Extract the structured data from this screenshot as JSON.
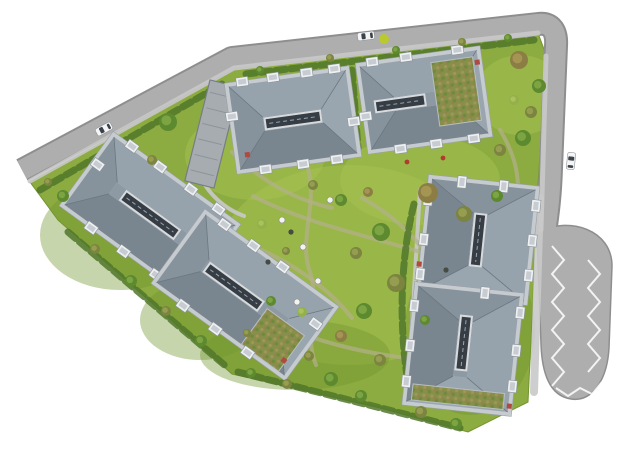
{
  "meta": {
    "type": "architectural-site-plan-rendering",
    "description": "Top-down aerial rendering of a residential masterplan: six apartment buildings with grey hip roofs, central skylight strips, white rooftop boxes and green-roof patches, set in a yellow-green landscaped garden with winding paths and trees, bounded by grey roads with three white cars and a parking loop with zigzag markings.",
    "canvas": {
      "width": 620,
      "height": 465
    }
  },
  "palette": {
    "grass": "#8cab40",
    "grass_light": "#a6c152",
    "grass_dark": "#71952f",
    "road": "#aeaeae",
    "road_edge": "#8e8e8e",
    "walk": "#c9c9c9",
    "marking": "#ffffff",
    "path_tan": "#b4b18c",
    "hedge": "#50772a",
    "slab": "#c6cbd0",
    "face_n": "#97a3ac",
    "face_s": "#79858f",
    "face_w": "#87939c",
    "face_e": "#9aa6af",
    "ridge": "#8e9aa3",
    "hipline": "#6b7680",
    "sky": "#363d44",
    "sky_frame": "#d7dbde",
    "roofbox": "#eef0f1",
    "box_edge": "#8a939b",
    "box_inner": "#c6ccd1",
    "vent": "#b0493f",
    "flower": "#b23b30",
    "car_body": "#f5f5f5",
    "car_glass": "#3a424c",
    "lime": "#b9c92e",
    "greenroof_base": "#878f4a",
    "greenroof_dot1": "#a09659",
    "greenroof_dot2": "#6f8a3e",
    "greenroof_dot3": "#96804c",
    "tree_green": "#5d892f",
    "tree_green_hi": "#81a945",
    "tree_olive": "#7c8440",
    "tree_olive_hi": "#9aa254",
    "tree_brown": "#8c7d45",
    "tree_brown_hi": "#a89a55",
    "tree_light": "#93b04b",
    "tree_light_hi": "#aec45f"
  },
  "scene": {
    "site_outline": "30,182 237,68 538,33 545,52 541,140 536,215 533,300 528,402 468,432 380,408 232,374 58,220",
    "lawn_patches": [
      [
        350,
        265,
        135,
        100,
        "light"
      ],
      [
        255,
        155,
        70,
        45,
        "light"
      ],
      [
        520,
        95,
        45,
        40,
        "light"
      ],
      [
        420,
        180,
        80,
        45,
        "light"
      ],
      [
        120,
        235,
        80,
        55,
        "dark"
      ],
      [
        470,
        330,
        65,
        85,
        "dark"
      ],
      [
        295,
        355,
        95,
        35,
        "dark"
      ],
      [
        200,
        320,
        60,
        40,
        "dark"
      ]
    ],
    "road_centerline": "M 22 170 L 232 58 L 538 24 C 552 22 557 32 556 46 L 551 168 C 550 200 547 218 544 240",
    "bulb_path": "M 537 232 C 570 216 612 230 612 266 L 609 348 C 607 382 591 402 571 399 C 550 396 542 374 541 344 L 538 262 Z",
    "walkways": [
      {
        "d": "M 30 181 L 234 68 L 538 33",
        "w": 5
      },
      {
        "d": "M 546 56 L 541 230",
        "w": 5
      },
      {
        "d": "M 540 198 L 534 392",
        "w": 8
      },
      {
        "d": "M 420 190 L 408 390",
        "w": 4
      },
      {
        "d": "M 205 185 C 215 200 228 210 244 216",
        "w": 4
      }
    ],
    "zigzag_markings": [
      "552,246 564,260 552,274 564,288 552,302 564,316 552,330 564,344 552,358 564,372 552,386",
      "588,260 600,274 588,288 600,302 588,316 600,330 588,344 600,358 588,372",
      "556,388 568,396 580,388 592,394 602,382"
    ],
    "garden_paths": [
      "M 308 168 C 318 205 298 240 310 272 C 320 300 303 335 316 365",
      "M 253 196 C 310 226 380 238 446 260",
      "M 232 152 C 262 182 296 200 332 208",
      "M 362 198 C 402 220 432 252 446 292 C 456 322 442 352 424 382",
      "M 292 330 C 332 346 372 354 420 360",
      "M 500 130 C 512 150 518 168 518 188",
      "M 262 250 C 300 268 330 290 352 318"
    ],
    "hedges": [
      "M 246 74 L 534 40",
      "M 40 190 L 222 84",
      "M 68 232 L 228 368",
      "M 238 372 L 460 428",
      "M 414 204 C 400 260 398 330 410 394",
      "M 352 70 L 358 148"
    ],
    "ramp": {
      "x": 212,
      "y": 134,
      "rot": 14,
      "w": 30,
      "len": 104,
      "ticks": 6
    },
    "buildings": [
      {
        "cx": 293,
        "cy": 120,
        "long": 118,
        "short": 84,
        "rot": -8,
        "sky": 54,
        "skyx": 0,
        "boxes": [
          [
            -45,
            -45
          ],
          [
            -14,
            -45
          ],
          [
            20,
            -45
          ],
          [
            48,
            -45
          ],
          [
            -34,
            45
          ],
          [
            4,
            45
          ],
          [
            38,
            45
          ],
          [
            -60,
            -12
          ],
          [
            60,
            10
          ]
        ],
        "vents": [
          [
            -50,
            28
          ]
        ]
      },
      {
        "cx": 424,
        "cy": 100,
        "long": 118,
        "short": 84,
        "rot": -8,
        "sky": 48,
        "skyx": -24,
        "patch": [
          12,
          -36,
          42,
          64
        ],
        "boxes": [
          [
            -46,
            -45
          ],
          [
            -12,
            -45
          ],
          [
            40,
            -45
          ],
          [
            -30,
            45
          ],
          [
            6,
            45
          ],
          [
            44,
            45
          ],
          [
            -60,
            8
          ]
        ],
        "vents": [
          [
            58,
            -30
          ]
        ]
      },
      {
        "cx": 150,
        "cy": 215,
        "long": 150,
        "short": 84,
        "rot": 36,
        "sky": 64,
        "skyx": 0,
        "boxes": [
          [
            -55,
            -45
          ],
          [
            -20,
            -45
          ],
          [
            18,
            -45
          ],
          [
            52,
            -45
          ],
          [
            -40,
            45
          ],
          [
            0,
            45
          ],
          [
            40,
            45
          ],
          [
            -72,
            -10
          ],
          [
            72,
            12
          ]
        ],
        "vents": []
      },
      {
        "cx": 245,
        "cy": 295,
        "long": 158,
        "short": 84,
        "rot": 36,
        "sky": 64,
        "skyx": -14,
        "patch": [
          26,
          -2,
          46,
          44
        ],
        "boxes": [
          [
            -58,
            -45
          ],
          [
            -22,
            -45
          ],
          [
            14,
            -45
          ],
          [
            -44,
            45
          ],
          [
            -4,
            45
          ],
          [
            36,
            45
          ],
          [
            74,
            -18
          ]
        ],
        "vents": [
          [
            70,
            30
          ]
        ]
      },
      {
        "cx": 478,
        "cy": 240,
        "long": 112,
        "short": 104,
        "rot": 96,
        "sky": 50,
        "skyx": 0,
        "boxes": [
          [
            -40,
            -54
          ],
          [
            -5,
            -54
          ],
          [
            30,
            -54
          ],
          [
            -35,
            54
          ],
          [
            5,
            54
          ],
          [
            40,
            54
          ],
          [
            -56,
            -20
          ],
          [
            -56,
            22
          ]
        ],
        "vents": [
          [
            30,
            56
          ]
        ]
      },
      {
        "cx": 463,
        "cy": 349,
        "long": 116,
        "short": 102,
        "rot": 96,
        "sky": 52,
        "skyx": -6,
        "patch": [
          40,
          -46,
          16,
          92
        ],
        "boxes": [
          [
            -42,
            -53
          ],
          [
            -4,
            -53
          ],
          [
            32,
            -53
          ],
          [
            -38,
            53
          ],
          [
            2,
            53
          ],
          [
            38,
            53
          ],
          [
            -58,
            -16
          ]
        ],
        "vents": [
          [
            52,
            -52
          ]
        ]
      }
    ],
    "trees": [
      [
        519,
        60,
        9,
        "brown"
      ],
      [
        539,
        86,
        7,
        "green"
      ],
      [
        531,
        112,
        6,
        "olive"
      ],
      [
        514,
        100,
        5,
        "light"
      ],
      [
        523,
        138,
        8,
        "green"
      ],
      [
        500,
        150,
        6,
        "olive"
      ],
      [
        168,
        122,
        9,
        "green"
      ],
      [
        152,
        160,
        5,
        "olive"
      ],
      [
        63,
        196,
        6,
        "green"
      ],
      [
        48,
        182,
        4,
        "olive"
      ],
      [
        313,
        185,
        5,
        "olive"
      ],
      [
        341,
        200,
        6,
        "green"
      ],
      [
        368,
        192,
        5,
        "brown"
      ],
      [
        428,
        193,
        10,
        "brown"
      ],
      [
        464,
        214,
        8,
        "olive"
      ],
      [
        497,
        196,
        6,
        "green"
      ],
      [
        381,
        232,
        9,
        "green"
      ],
      [
        356,
        253,
        6,
        "olive"
      ],
      [
        396,
        283,
        9,
        "olive"
      ],
      [
        364,
        311,
        8,
        "green"
      ],
      [
        341,
        336,
        6,
        "brown"
      ],
      [
        309,
        356,
        5,
        "olive"
      ],
      [
        331,
        379,
        7,
        "green"
      ],
      [
        262,
        224,
        5,
        "light"
      ],
      [
        286,
        251,
        4,
        "olive"
      ],
      [
        271,
        301,
        5,
        "green"
      ],
      [
        247,
        333,
        4,
        "olive"
      ],
      [
        95,
        249,
        5,
        "olive"
      ],
      [
        131,
        281,
        6,
        "green"
      ],
      [
        166,
        311,
        5,
        "olive"
      ],
      [
        201,
        341,
        6,
        "green"
      ],
      [
        251,
        373,
        5,
        "green"
      ],
      [
        287,
        384,
        5,
        "olive"
      ],
      [
        361,
        396,
        6,
        "green"
      ],
      [
        421,
        412,
        6,
        "olive"
      ],
      [
        456,
        424,
        6,
        "green"
      ],
      [
        380,
        360,
        6,
        "olive"
      ],
      [
        425,
        320,
        5,
        "green"
      ],
      [
        302,
        312,
        5,
        "light"
      ],
      [
        260,
        70,
        4,
        "green"
      ],
      [
        330,
        58,
        4,
        "olive"
      ],
      [
        396,
        50,
        4,
        "green"
      ],
      [
        462,
        42,
        4,
        "olive"
      ],
      [
        508,
        38,
        4,
        "green"
      ]
    ],
    "furniture_white": [
      [
        330,
        200
      ],
      [
        303,
        247
      ],
      [
        282,
        220
      ],
      [
        297,
        302
      ],
      [
        318,
        281
      ]
    ],
    "furniture_dark": [
      [
        291,
        232
      ],
      [
        268,
        262
      ],
      [
        446,
        270
      ]
    ],
    "flowers": [
      [
        443,
        158
      ],
      [
        407,
        162
      ]
    ],
    "shrub_lime": [
      384,
      39,
      5
    ],
    "cars": [
      {
        "x": 104,
        "y": 129,
        "rot": -28
      },
      {
        "x": 366,
        "y": 36,
        "rot": -7
      },
      {
        "x": 571,
        "y": 161,
        "rot": 96
      }
    ]
  }
}
